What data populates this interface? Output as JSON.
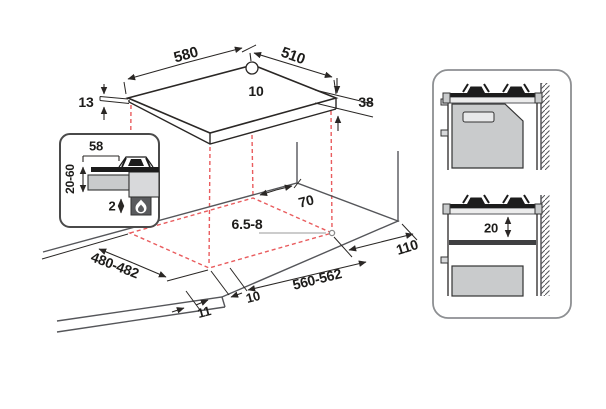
{
  "dimensions": {
    "hob": {
      "width": "580",
      "depth": "510",
      "hole_offset": "10",
      "edge_thickness": "13",
      "body_height": "38"
    },
    "side_section_inset": {
      "burner_offset": "58",
      "under_counter_clearance": "20-60",
      "bottom_gap": "2"
    },
    "worktop_cutout": {
      "rear_clearance": "70",
      "fixing_hole_diameter": "6.5-8",
      "right_clearance": "110",
      "cutout_width": "560-562",
      "side_offset": "10",
      "front_offset": "11",
      "cutout_depth": "480-482"
    },
    "side_panel": {
      "shelf_clearance": "20"
    }
  },
  "icons": {
    "flame": "gas-flame-icon",
    "mounting_hole": "mounting-hole-icon"
  },
  "colors": {
    "line": "#2a2725",
    "worktop_line": "#55565a",
    "projection_dashed": "#e95c5e",
    "fill_light": "#d8d9db",
    "fill_mid": "#c9cbcc",
    "fill_dark": "#1c1c1c",
    "flame_box": "#5a5b5e",
    "panel_border": "#8d8f92"
  }
}
